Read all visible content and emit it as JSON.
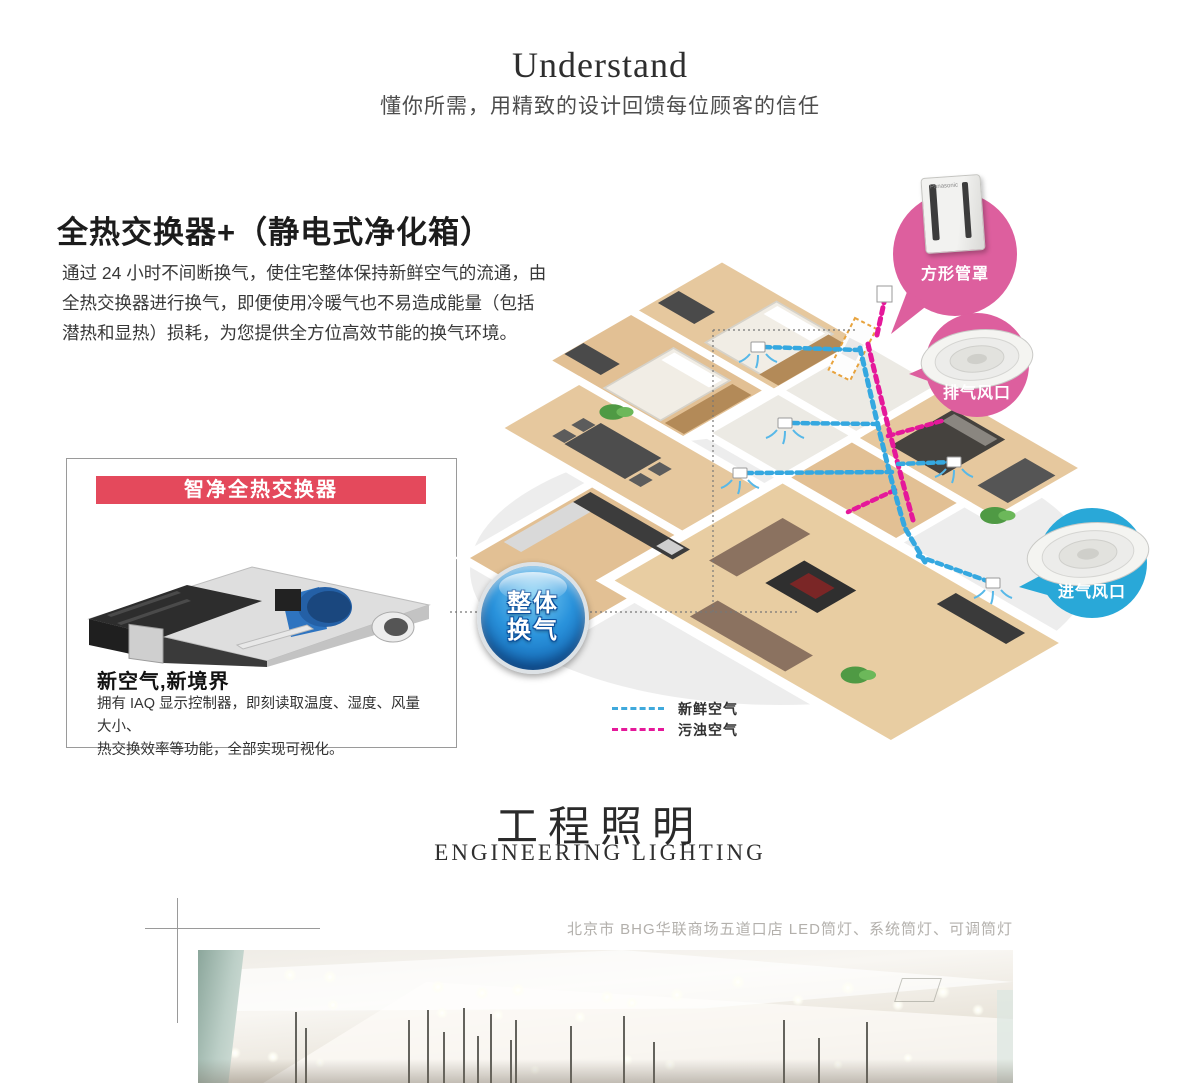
{
  "header": {
    "title": "Understand",
    "subtitle": "懂你所需，用精致的设计回馈每位顾客的信任"
  },
  "section_ventilation": {
    "heading": "全热交换器+（静电式净化箱）",
    "paragraph_lines": [
      "通过 24 小时不间断换气，使住宅整体保持新鲜空气的流通，由",
      "全热交换器进行换气，即便使用冷暖气也不易造成能量（包括",
      "潜热和显热）损耗，为您提供全方位高效节能的换气环境。"
    ],
    "product_box": {
      "banner": "智净全热交换器",
      "banner_color": "#e4495c",
      "title": "新空气,新境界",
      "desc_lines": [
        "拥有 IAQ 显示控制器，即刻读取温度、湿度、风量大小、",
        "热交换效率等功能，全部实现可视化。"
      ]
    },
    "badge": {
      "line1": "整体",
      "line2": "换气",
      "color": "#0f6fc8"
    },
    "callouts": [
      {
        "label": "方形管罩",
        "color": "#dd5f9e",
        "product_logo": "Panasonic"
      },
      {
        "label": "排气风口",
        "color": "#dd5f9e"
      },
      {
        "label": "进气风口",
        "color": "#29a8d8"
      }
    ],
    "legend": [
      {
        "label": "新鲜空气",
        "color": "#3fa9dc"
      },
      {
        "label": "污浊空气",
        "color": "#e5189a"
      }
    ]
  },
  "section_lighting": {
    "title": "工程照明",
    "subtitle": "ENGINEERING LIGHTING",
    "caption": "北京市 BHG华联商场五道口店 LED筒灯、系统筒灯、可调筒灯"
  }
}
